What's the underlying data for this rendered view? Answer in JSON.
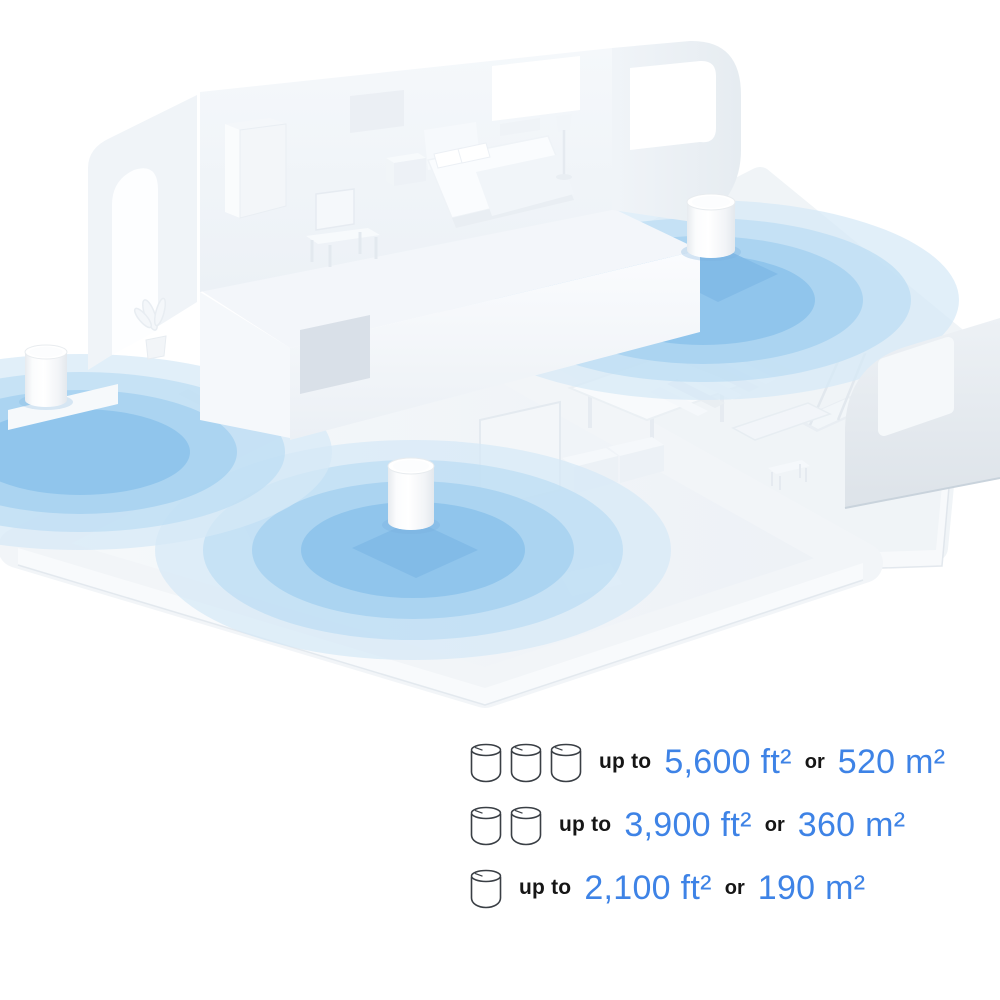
{
  "scene": {
    "description": "Isometric white smart-home cutaway with three mesh WiFi units broadcasting concentric blue coverage circles",
    "signal_color": "#8DC3EB",
    "devices": [
      "deco-unit-upper-floor",
      "deco-unit-left",
      "deco-unit-living-room"
    ]
  },
  "coverage": {
    "accent_color": "#3E83E6",
    "text_color": "#161616",
    "rows": [
      {
        "units": 3,
        "up_to": "up to",
        "ft": "5,600 ft²",
        "or": "or",
        "m": "520 m²"
      },
      {
        "units": 2,
        "up_to": "up to",
        "ft": "3,900 ft²",
        "or": "or",
        "m": "360 m²"
      },
      {
        "units": 1,
        "up_to": "up to",
        "ft": "2,100 ft²",
        "or": "or",
        "m": "190 m²"
      }
    ]
  }
}
